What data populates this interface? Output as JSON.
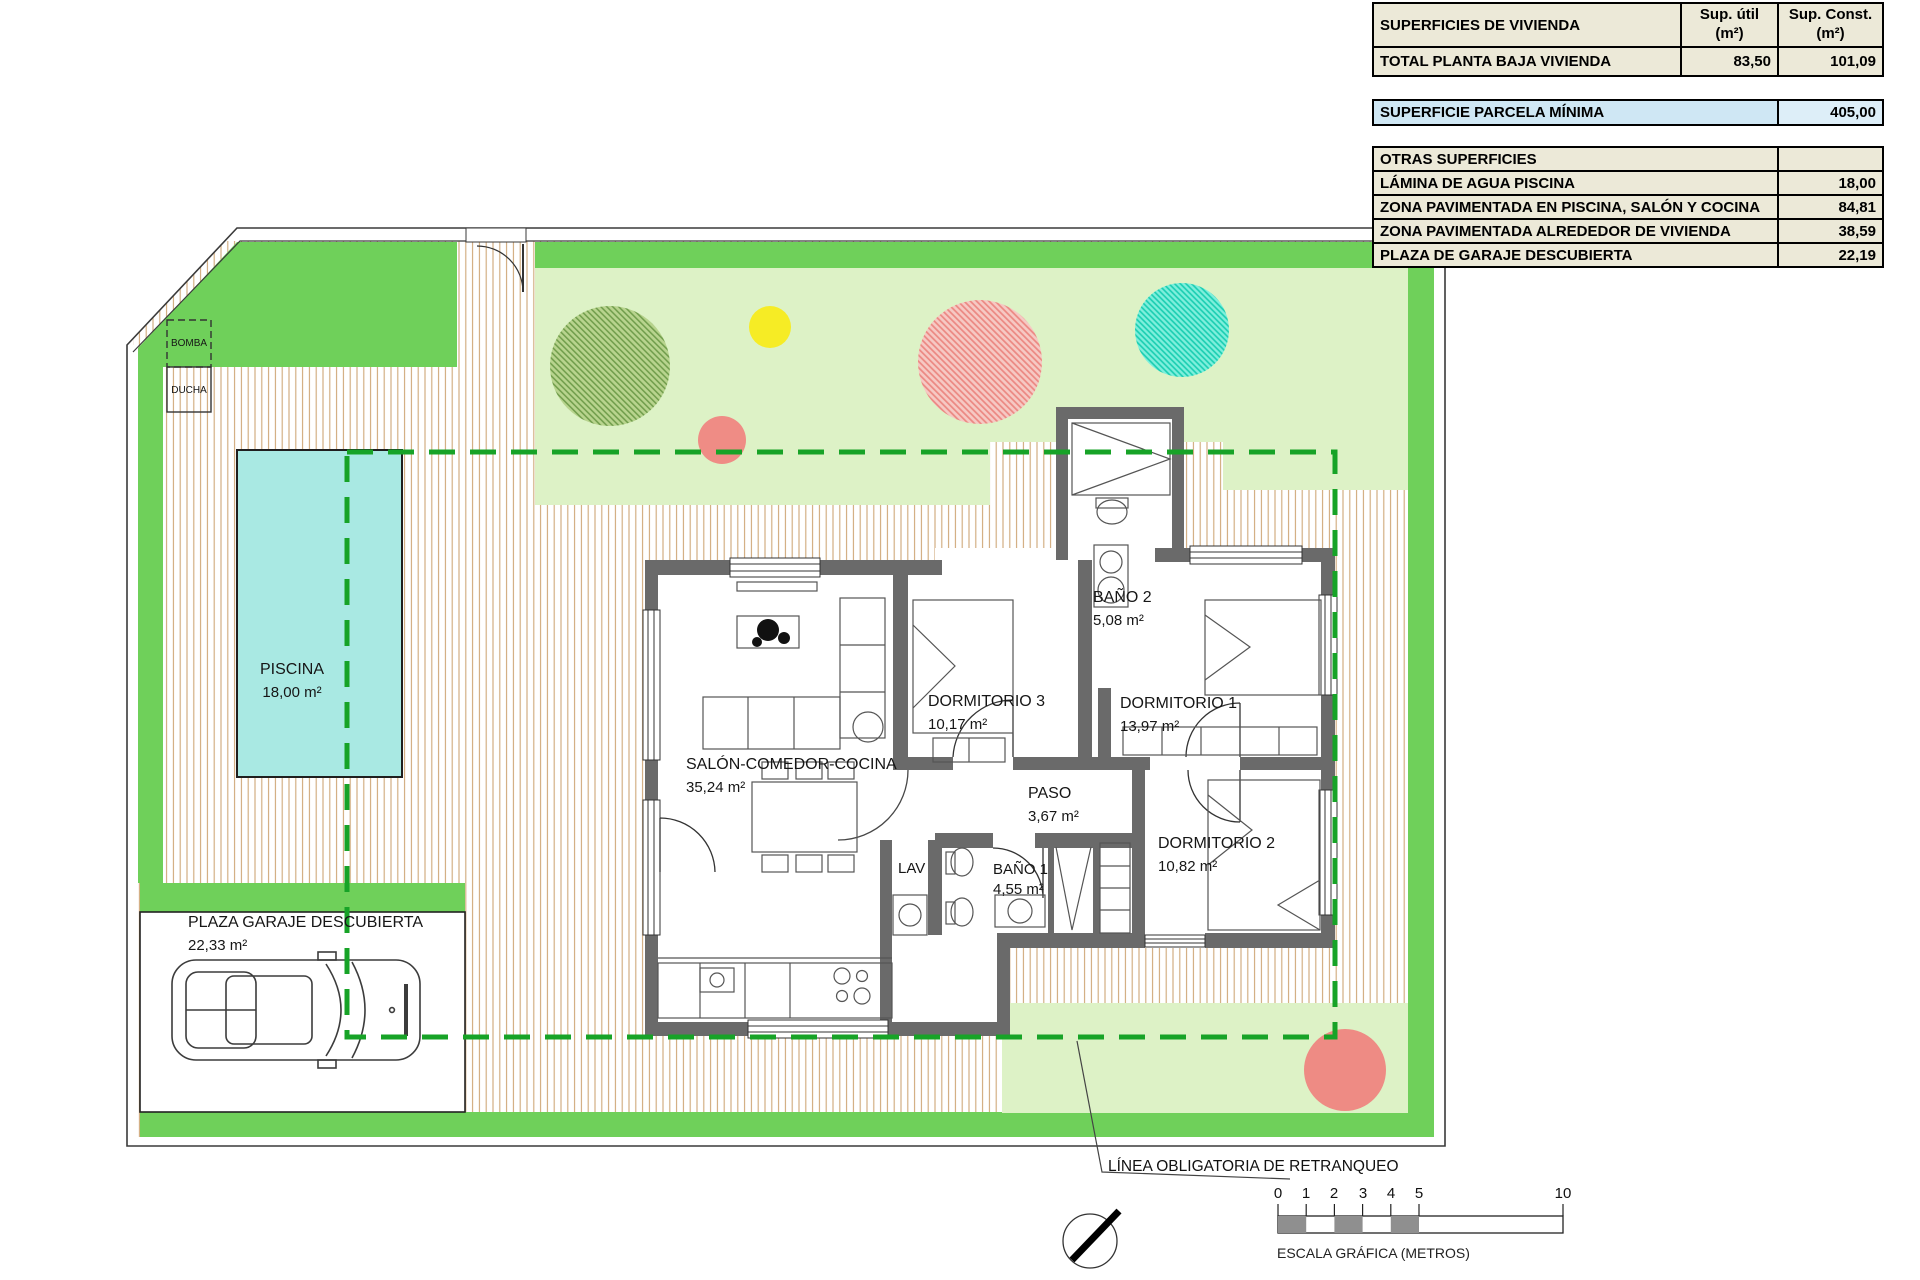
{
  "surfaces_table": {
    "title": "SUPERFICIES DE VIVIENDA",
    "col_util_line1": "Sup. útil",
    "col_util_line2": "(m²)",
    "col_const_line1": "Sup. Const.",
    "col_const_line2": "(m²)",
    "row_label": "TOTAL PLANTA BAJA VIVIENDA",
    "row_util": "83,50",
    "row_const": "101,09"
  },
  "parcela_row": {
    "label": "SUPERFICIE PARCELA MÍNIMA",
    "value": "405,00"
  },
  "otras_table": {
    "header": "OTRAS SUPERFICIES",
    "rows": [
      {
        "label": "LÁMINA DE AGUA PISCINA",
        "value": "18,00"
      },
      {
        "label": "ZONA PAVIMENTADA EN PISCINA, SALÓN Y COCINA",
        "value": "84,81"
      },
      {
        "label": "ZONA PAVIMENTADA ALREDEDOR DE VIVIENDA",
        "value": "38,59"
      },
      {
        "label": "PLAZA DE GARAJE DESCUBIERTA",
        "value": "22,19"
      }
    ]
  },
  "rooms": {
    "piscina": {
      "name": "PISCINA",
      "area": "18,00 m²"
    },
    "salon": {
      "name": "SALÓN-COMEDOR-COCINA",
      "area": "35,24 m²"
    },
    "dormitorio3": {
      "name": "DORMITORIO 3",
      "area": "10,17 m²"
    },
    "bano2": {
      "name": "BAÑO 2",
      "area": "5,08 m²"
    },
    "dormitorio1": {
      "name": "DORMITORIO 1",
      "area": "13,97 m²"
    },
    "paso": {
      "name": "PASO",
      "area": "3,67 m²"
    },
    "bano1": {
      "name": "BAÑO 1",
      "area": "4,55 m²"
    },
    "dormitorio2": {
      "name": "DORMITORIO 2",
      "area": "10,82 m²"
    },
    "lav": {
      "name": "LAV"
    },
    "garaje": {
      "name": "PLAZA GARAJE DESCUBIERTA",
      "area": "22,33 m²"
    },
    "bomba": {
      "name": "BOMBA"
    },
    "ducha": {
      "name": "DUCHA"
    }
  },
  "annotations": {
    "retranqueo": "LÍNEA OBLIGATORIA DE RETRANQUEO"
  },
  "scalebar": {
    "n0": "0",
    "n1": "1",
    "n2": "2",
    "n3": "3",
    "n4": "4",
    "n5": "5",
    "n10": "10",
    "caption": "ESCALA GRÁFICA (METROS)"
  },
  "colors": {
    "lawn": "#6fd05a",
    "garden": "#ddf2c6",
    "pool": "#a9e9e3",
    "wall": "#6a6a6a",
    "setback": "#17a327",
    "table_beige": "#ece9d8",
    "table_blue": "#cfe7f4"
  }
}
